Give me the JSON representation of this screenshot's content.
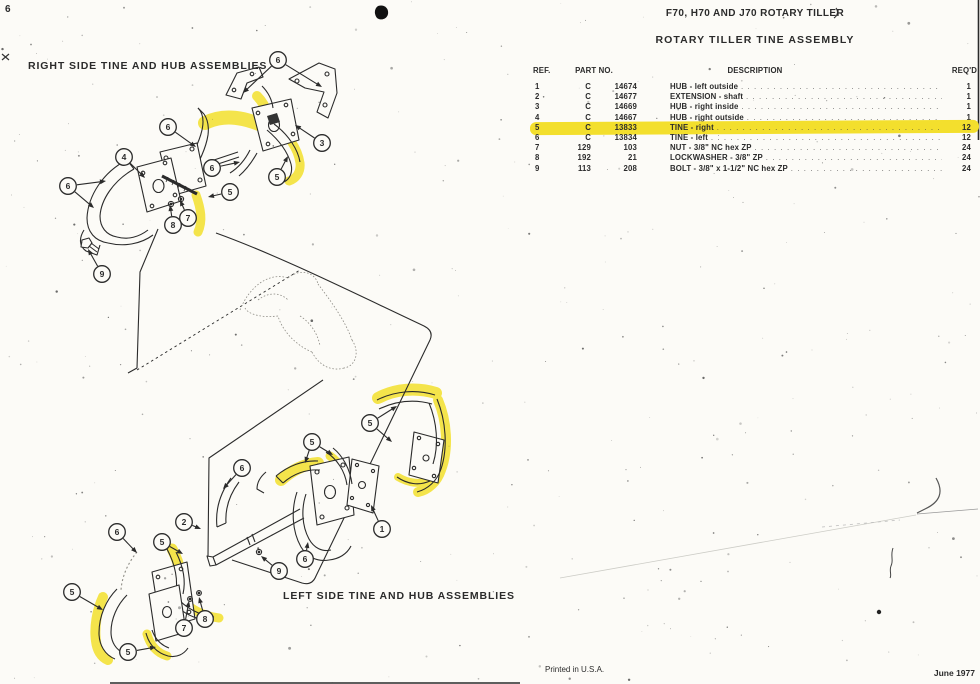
{
  "page": {
    "page_number": "6",
    "doc_title": "F70, H70 AND J70 ROTARY TILLER",
    "table_title": "ROTARY TILLER TINE ASSEMBLY",
    "footer_left": "Printed in U.S.A.",
    "footer_right": "June 1977"
  },
  "diagram": {
    "top_label": "RIGHT SIDE TINE AND HUB ASSEMBLIES",
    "bottom_label": "LEFT SIDE TINE AND HUB ASSEMBLIES",
    "callouts_top": [
      {
        "n": "6",
        "x": 278,
        "y": 60,
        "targets": [
          [
            243,
            93
          ],
          [
            322,
            87
          ]
        ]
      },
      {
        "n": "6",
        "x": 168,
        "y": 127,
        "targets": [
          [
            196,
            147
          ]
        ]
      },
      {
        "n": "4",
        "x": 124,
        "y": 157,
        "targets": [
          [
            145,
            178
          ]
        ]
      },
      {
        "n": "6",
        "x": 68,
        "y": 186,
        "targets": [
          [
            106,
            181
          ],
          [
            94,
            208
          ]
        ]
      },
      {
        "n": "3",
        "x": 322,
        "y": 143,
        "targets": [
          [
            295,
            125
          ]
        ]
      },
      {
        "n": "6",
        "x": 212,
        "y": 168,
        "targets": [
          [
            240,
            162
          ]
        ]
      },
      {
        "n": "5",
        "x": 277,
        "y": 177,
        "targets": [
          [
            288,
            156
          ]
        ]
      },
      {
        "n": "5",
        "x": 230,
        "y": 192,
        "targets": [
          [
            208,
            197
          ]
        ]
      },
      {
        "n": "7",
        "x": 188,
        "y": 218,
        "targets": [
          [
            180,
            200
          ]
        ]
      },
      {
        "n": "8",
        "x": 173,
        "y": 225,
        "targets": [
          [
            170,
            205
          ]
        ]
      },
      {
        "n": "9",
        "x": 102,
        "y": 274,
        "targets": [
          [
            88,
            249
          ]
        ]
      }
    ],
    "callouts_bottom": [
      {
        "n": "5",
        "x": 370,
        "y": 423,
        "targets": [
          [
            397,
            406
          ],
          [
            392,
            442
          ]
        ]
      },
      {
        "n": "5",
        "x": 312,
        "y": 442,
        "targets": [
          [
            305,
            463
          ],
          [
            333,
            455
          ]
        ]
      },
      {
        "n": "6",
        "x": 242,
        "y": 468,
        "targets": [
          [
            223,
            489
          ]
        ]
      },
      {
        "n": "2",
        "x": 184,
        "y": 522,
        "targets": [
          [
            201,
            529
          ]
        ]
      },
      {
        "n": "1",
        "x": 382,
        "y": 529,
        "targets": [
          [
            371,
            505
          ]
        ]
      },
      {
        "n": "6",
        "x": 305,
        "y": 559,
        "targets": [
          [
            308,
            542
          ]
        ]
      },
      {
        "n": "9",
        "x": 279,
        "y": 571,
        "targets": [
          [
            261,
            556
          ]
        ]
      },
      {
        "n": "6",
        "x": 117,
        "y": 532,
        "targets": [
          [
            137,
            553
          ]
        ]
      },
      {
        "n": "5",
        "x": 162,
        "y": 542,
        "targets": [
          [
            183,
            554
          ]
        ]
      },
      {
        "n": "5",
        "x": 72,
        "y": 592,
        "targets": [
          [
            103,
            610
          ]
        ]
      },
      {
        "n": "7",
        "x": 184,
        "y": 628,
        "targets": [
          [
            189,
            601
          ]
        ]
      },
      {
        "n": "8",
        "x": 205,
        "y": 619,
        "targets": [
          [
            199,
            597
          ]
        ]
      },
      {
        "n": "5",
        "x": 128,
        "y": 652,
        "targets": [
          [
            156,
            647
          ]
        ]
      }
    ]
  },
  "table": {
    "headers": {
      "ref": "REF.",
      "part": "PART NO.",
      "desc": "DESCRIPTION",
      "qty": "REQ'D"
    },
    "rows": [
      {
        "ref": "1",
        "prefix": "C",
        "part": "14674",
        "desc": "HUB - left outside",
        "qty": "1",
        "highlight": false
      },
      {
        "ref": "2",
        "prefix": "C",
        "part": "14677",
        "desc": "EXTENSION - shaft",
        "qty": "1",
        "highlight": false
      },
      {
        "ref": "3",
        "prefix": "C",
        "part": "14669",
        "desc": "HUB - right inside",
        "qty": "1",
        "highlight": false
      },
      {
        "ref": "4",
        "prefix": "C",
        "part": "14667",
        "desc": "HUB - right outside",
        "qty": "1",
        "highlight": false
      },
      {
        "ref": "5",
        "prefix": "C",
        "part": "13833",
        "desc": "TINE - right",
        "qty": "12",
        "highlight": true
      },
      {
        "ref": "6",
        "prefix": "C",
        "part": "13834",
        "desc": "TINE - left",
        "qty": "12",
        "highlight": false
      },
      {
        "ref": "7",
        "prefix": "129",
        "part": "103",
        "desc": "NUT - 3/8\" NC hex ZP",
        "qty": "24",
        "highlight": false
      },
      {
        "ref": "8",
        "prefix": "192",
        "part": "21",
        "desc": "LOCKWASHER - 3/8\" ZP",
        "qty": "24",
        "highlight": false
      },
      {
        "ref": "9",
        "prefix": "113",
        "part": "208",
        "desc": "BOLT - 3/8\" x 1-1/2\" NC hex ZP",
        "qty": "24",
        "highlight": false
      }
    ]
  },
  "colors": {
    "paper": "#fcfbf7",
    "ink": "#2b2b2b",
    "highlight": "#f3df2d"
  }
}
